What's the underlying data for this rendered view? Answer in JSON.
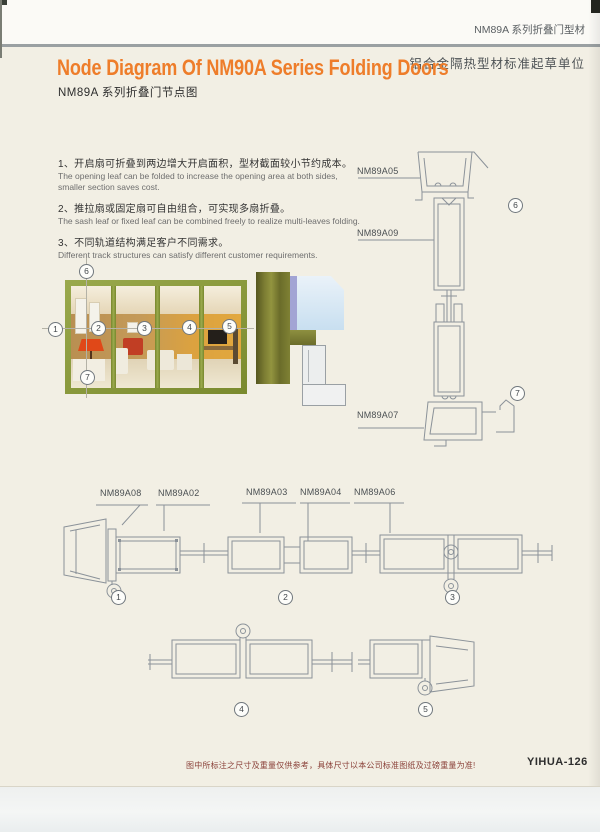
{
  "header": {
    "series_label": "NM89A 系列折叠门型材",
    "org_label": "铝合金隔热型材标准起草单位"
  },
  "title": {
    "en": "Node Diagram Of NM90A Series Folding Doors",
    "zh": "NM89A 系列折叠门节点图"
  },
  "notes": [
    {
      "zh": "1、开启扇可折叠到两边增大开启面积，型材截面较小节约成本。",
      "en": "The opening leaf can be folded to increase the opening area at both sides, smaller section saves cost."
    },
    {
      "zh": "2、推拉扇或固定扇可自由组合，可实现多扇折叠。",
      "en": "The sash leaf or fixed leaf can be combined freely to realize multi-leaves folding."
    },
    {
      "zh": "3、不同轨道结构满足客户不同需求。",
      "en": "Different track structures can satisfy different customer requirements."
    }
  ],
  "labels": {
    "a05": "NM89A05",
    "a09": "NM89A09",
    "a07": "NM89A07",
    "a08": "NM89A08",
    "a02": "NM89A02",
    "a03": "NM89A03",
    "a04": "NM89A04",
    "a06": "NM89A06"
  },
  "callouts": {
    "c1": "1",
    "c2": "2",
    "c3": "3",
    "c4": "4",
    "c5": "5",
    "c6": "6",
    "c7": "7"
  },
  "footer": {
    "disclaimer": "图中所标注之尺寸及重量仅供参考，具体尺寸以本公司标准图纸及过磅重量为准!",
    "page_code": "YIHUA-126"
  },
  "colors": {
    "accent_orange": "#ee7d2a",
    "frame_green": "#8a9a3c",
    "line_gray": "#8b9299",
    "footer_red": "#8a4038"
  }
}
